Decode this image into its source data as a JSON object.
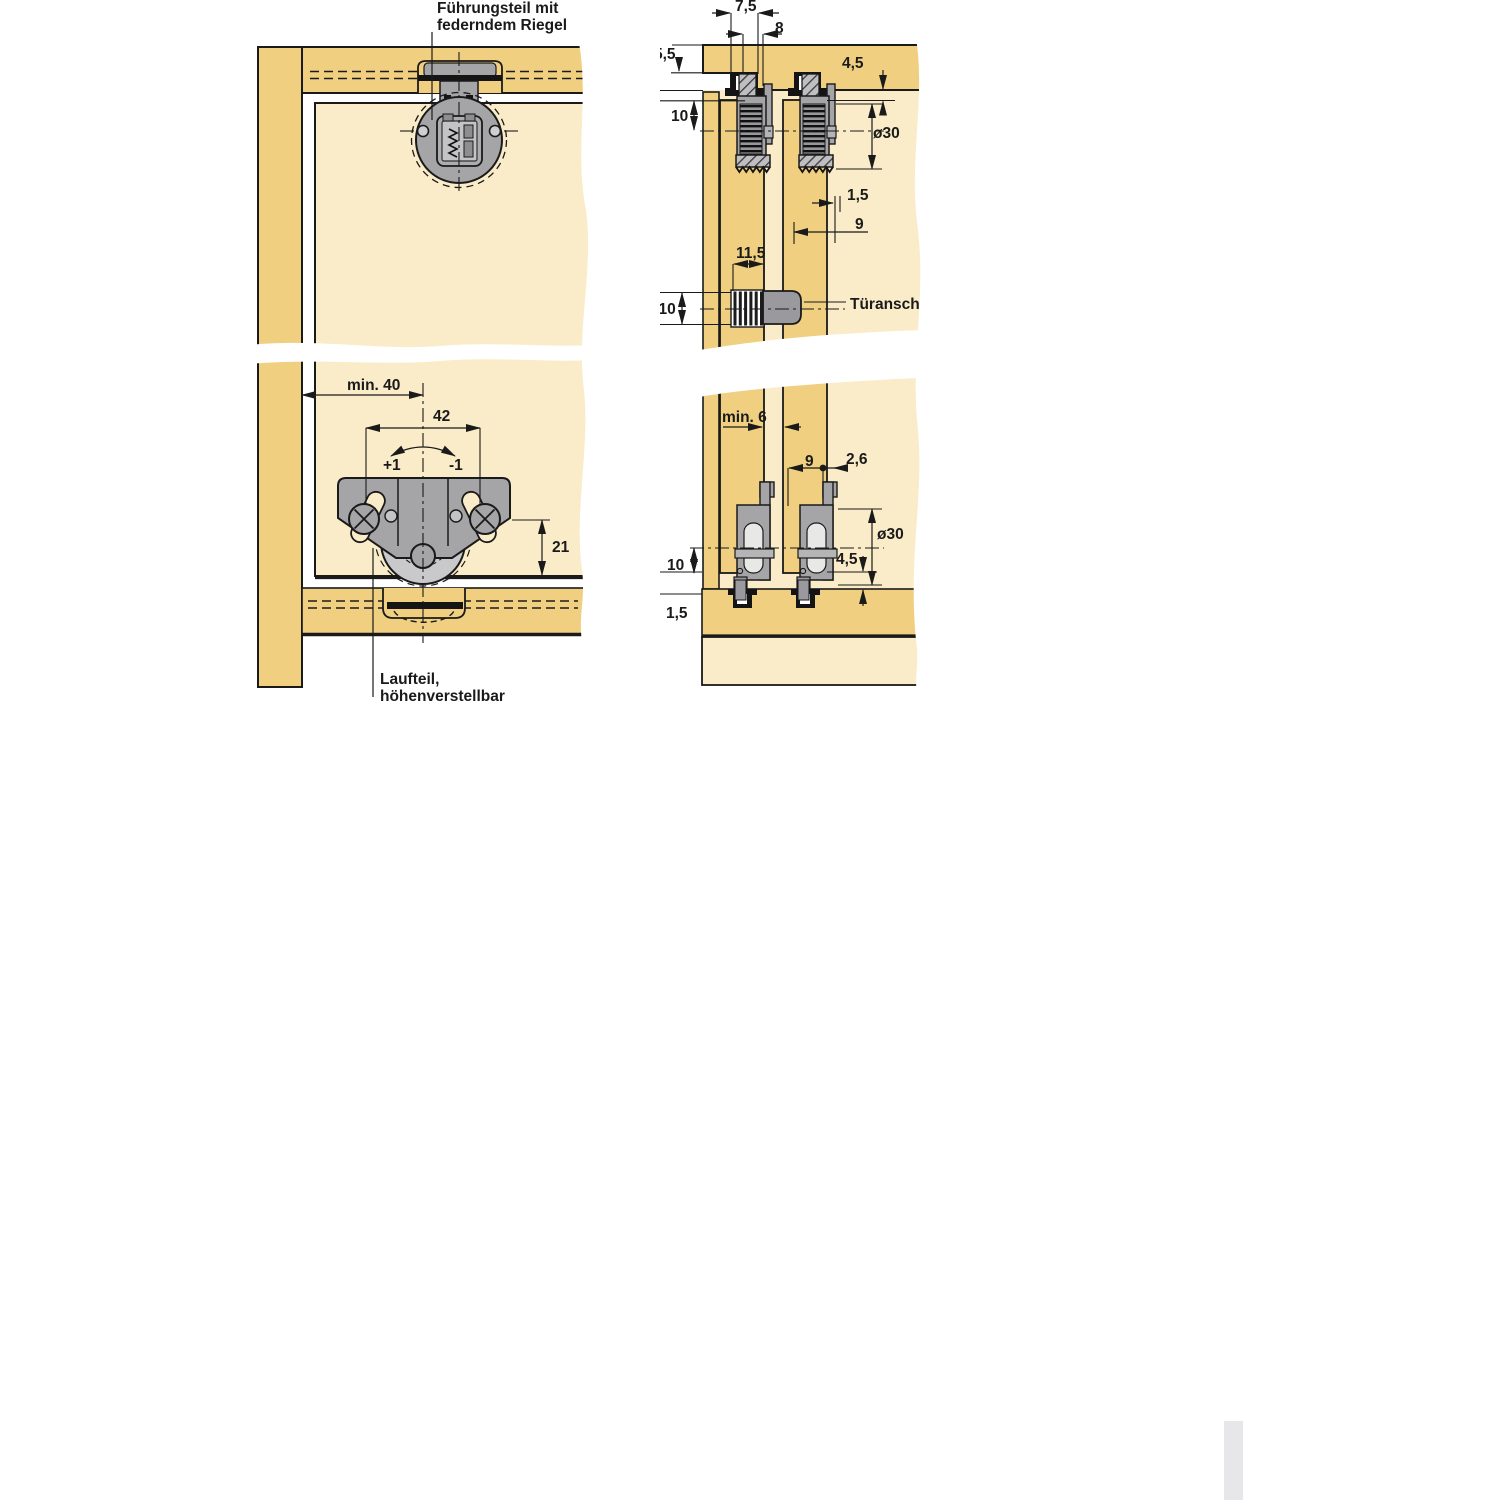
{
  "figure_type": "furniture-fitting installation drawing (sliding door hardware, cross sections)",
  "colors": {
    "wood": "#F0D080",
    "panel_light": "#FAECC8",
    "hardware_gray": "#A5A5A8",
    "hardware_light": "#C9C9CB",
    "track_black": "#141414",
    "line_dark": "#1a1a1a",
    "scrollbar": "#E7E7EA"
  },
  "labels": {
    "guide_line1": "Führungsteil mit",
    "guide_line2": "federndem Riegel",
    "runner_line1": "Laufteil,",
    "runner_line2": "höhenverstellbar",
    "door_stop": "Türanschlag"
  },
  "dims": {
    "min40": "min. 40",
    "d42": "42",
    "plus1": "+1",
    "minus1": "-1",
    "d21": "21",
    "d75": "7,5",
    "d8": "8",
    "d55": "5,5",
    "d45": "4,5",
    "d10": "10",
    "dia30": "ø30",
    "d15": "1,5",
    "d9": "9",
    "d115": "11,5",
    "dia10": "ø10",
    "min6": "min. 6",
    "d26": "2,6"
  }
}
